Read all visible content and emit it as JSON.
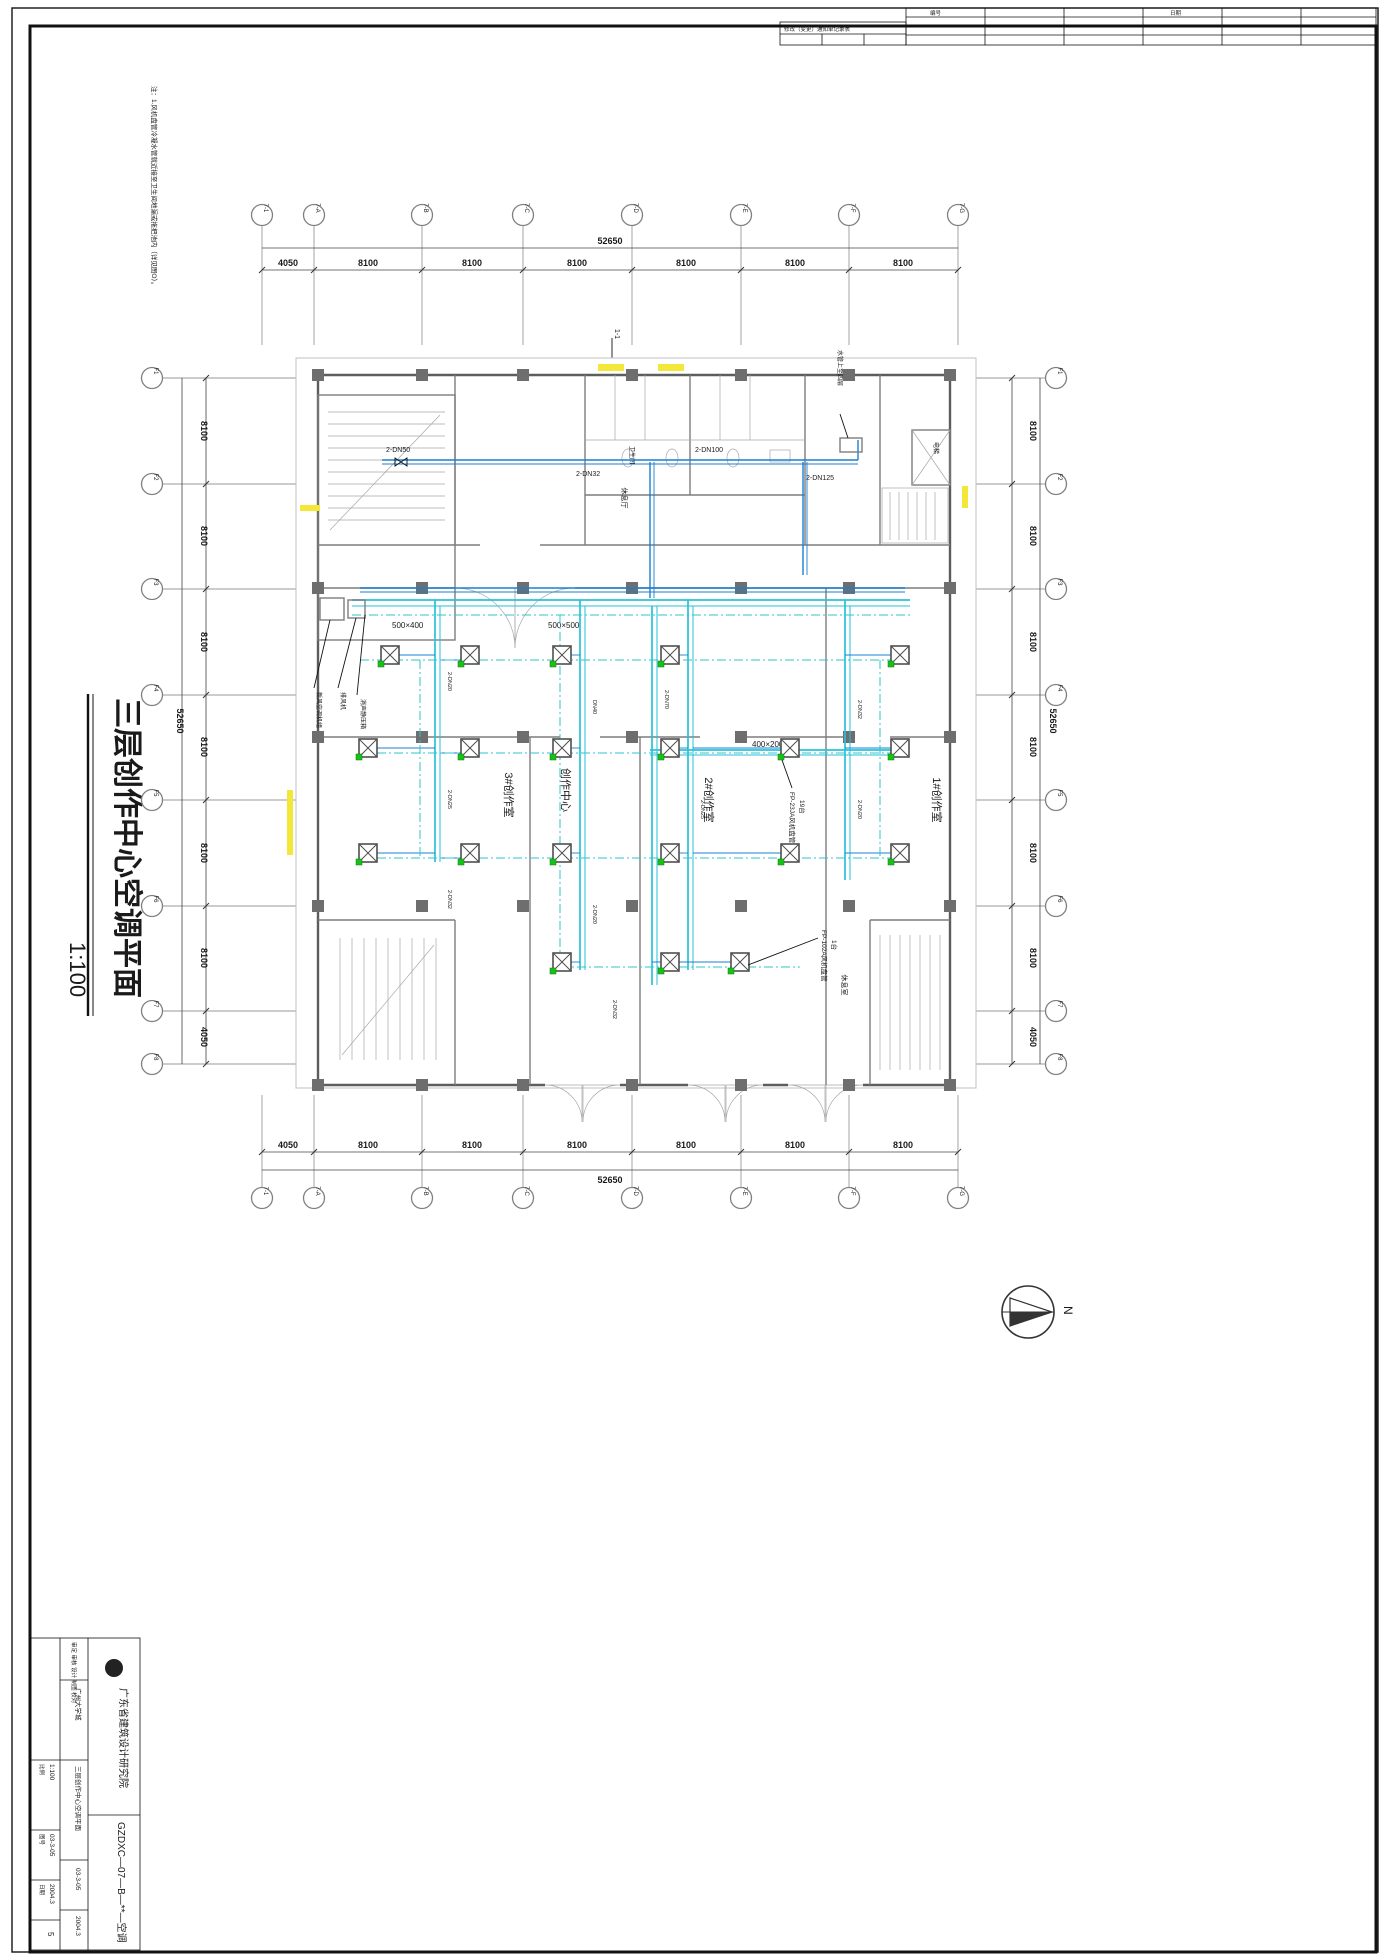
{
  "sheet": {
    "note": "注：1.风机盘管冷凝水管就近接至卫生间地漏或拖把池内（详见图O）。",
    "title": "三层创作中心空调平面",
    "scale": "1:100",
    "section_mark": "1-1",
    "north_label": "N"
  },
  "revision_table": {
    "title": "修改（变更）通知单记录表",
    "col1": "编号",
    "col2": "日期"
  },
  "grid": {
    "top": {
      "labels": [
        "7-1",
        "7-A",
        "7-B",
        "7-C",
        "7-D",
        "7-E",
        "7-F",
        "7-G"
      ],
      "dims": [
        "4050",
        "8100",
        "8100",
        "8100",
        "8100",
        "8100",
        "8100"
      ],
      "total": "52650"
    },
    "bottom": {
      "labels": [
        "7-1",
        "7-A",
        "7-B",
        "7-C",
        "7-D",
        "7-E",
        "7-F",
        "7-G"
      ],
      "dims": [
        "4050",
        "8100",
        "8100",
        "8100",
        "8100",
        "8100",
        "8100"
      ],
      "total": "52650"
    },
    "left": {
      "labels": [
        "F1",
        "F2",
        "F3",
        "F4",
        "F5",
        "F6",
        "F7",
        "F8"
      ],
      "dims": [
        "8100",
        "8100",
        "8100",
        "8100",
        "8100",
        "8100",
        "4050"
      ],
      "total": "52650"
    },
    "right": {
      "labels": [
        "F1",
        "F2",
        "F3",
        "F4",
        "F5",
        "F6",
        "F7",
        "F8"
      ],
      "dims": [
        "8100",
        "8100",
        "8100",
        "8100",
        "8100",
        "8100",
        "4050"
      ],
      "total": "52650"
    }
  },
  "rooms": {
    "studio3": "3#创作室",
    "center": "创作中心",
    "studio2": "2#创作室",
    "studio1": "1#创作室",
    "toilet": "卫生间",
    "elevator": "电梯",
    "lounge": "休息厅",
    "rest": "休息室"
  },
  "hvac": {
    "corridor_pipes": {
      "left": "2-DN50",
      "mid": "2-DN32",
      "right2": "2-DN100",
      "right": "2-DN125"
    },
    "duct_sizes": {
      "d1": "500×400",
      "d2": "500×500",
      "d3": "400×200"
    },
    "branch_pipes": {
      "p20": "2-DN20",
      "p25": "2-DN25",
      "p32": "2-DN32",
      "p40": "DN40",
      "p70": "2-DN70"
    },
    "fcu": {
      "fp23": "FP-23JA风机盘管",
      "fp23_count": "19台",
      "fp102": "FP-102A风机盘管",
      "fp102_count": "1台"
    },
    "equipment": {
      "ahu": "新风空调机组",
      "fan": "排风机",
      "silencer": "消声静压箱",
      "riser": "水管上至四层"
    }
  },
  "title_block": {
    "company": "广东省建筑设计研究院",
    "code": "GZDXC—07—B—**—空调",
    "project": "广州大学城",
    "drawing_title": "三层创作中心空调平面",
    "roles": "审定 审核 设计 制图 校对",
    "scale_label": "比例",
    "scale": "1:100",
    "no_label": "图号",
    "no": "03-3-05",
    "date_label": "日期",
    "date": "2004.3",
    "sheet_no": "5"
  }
}
